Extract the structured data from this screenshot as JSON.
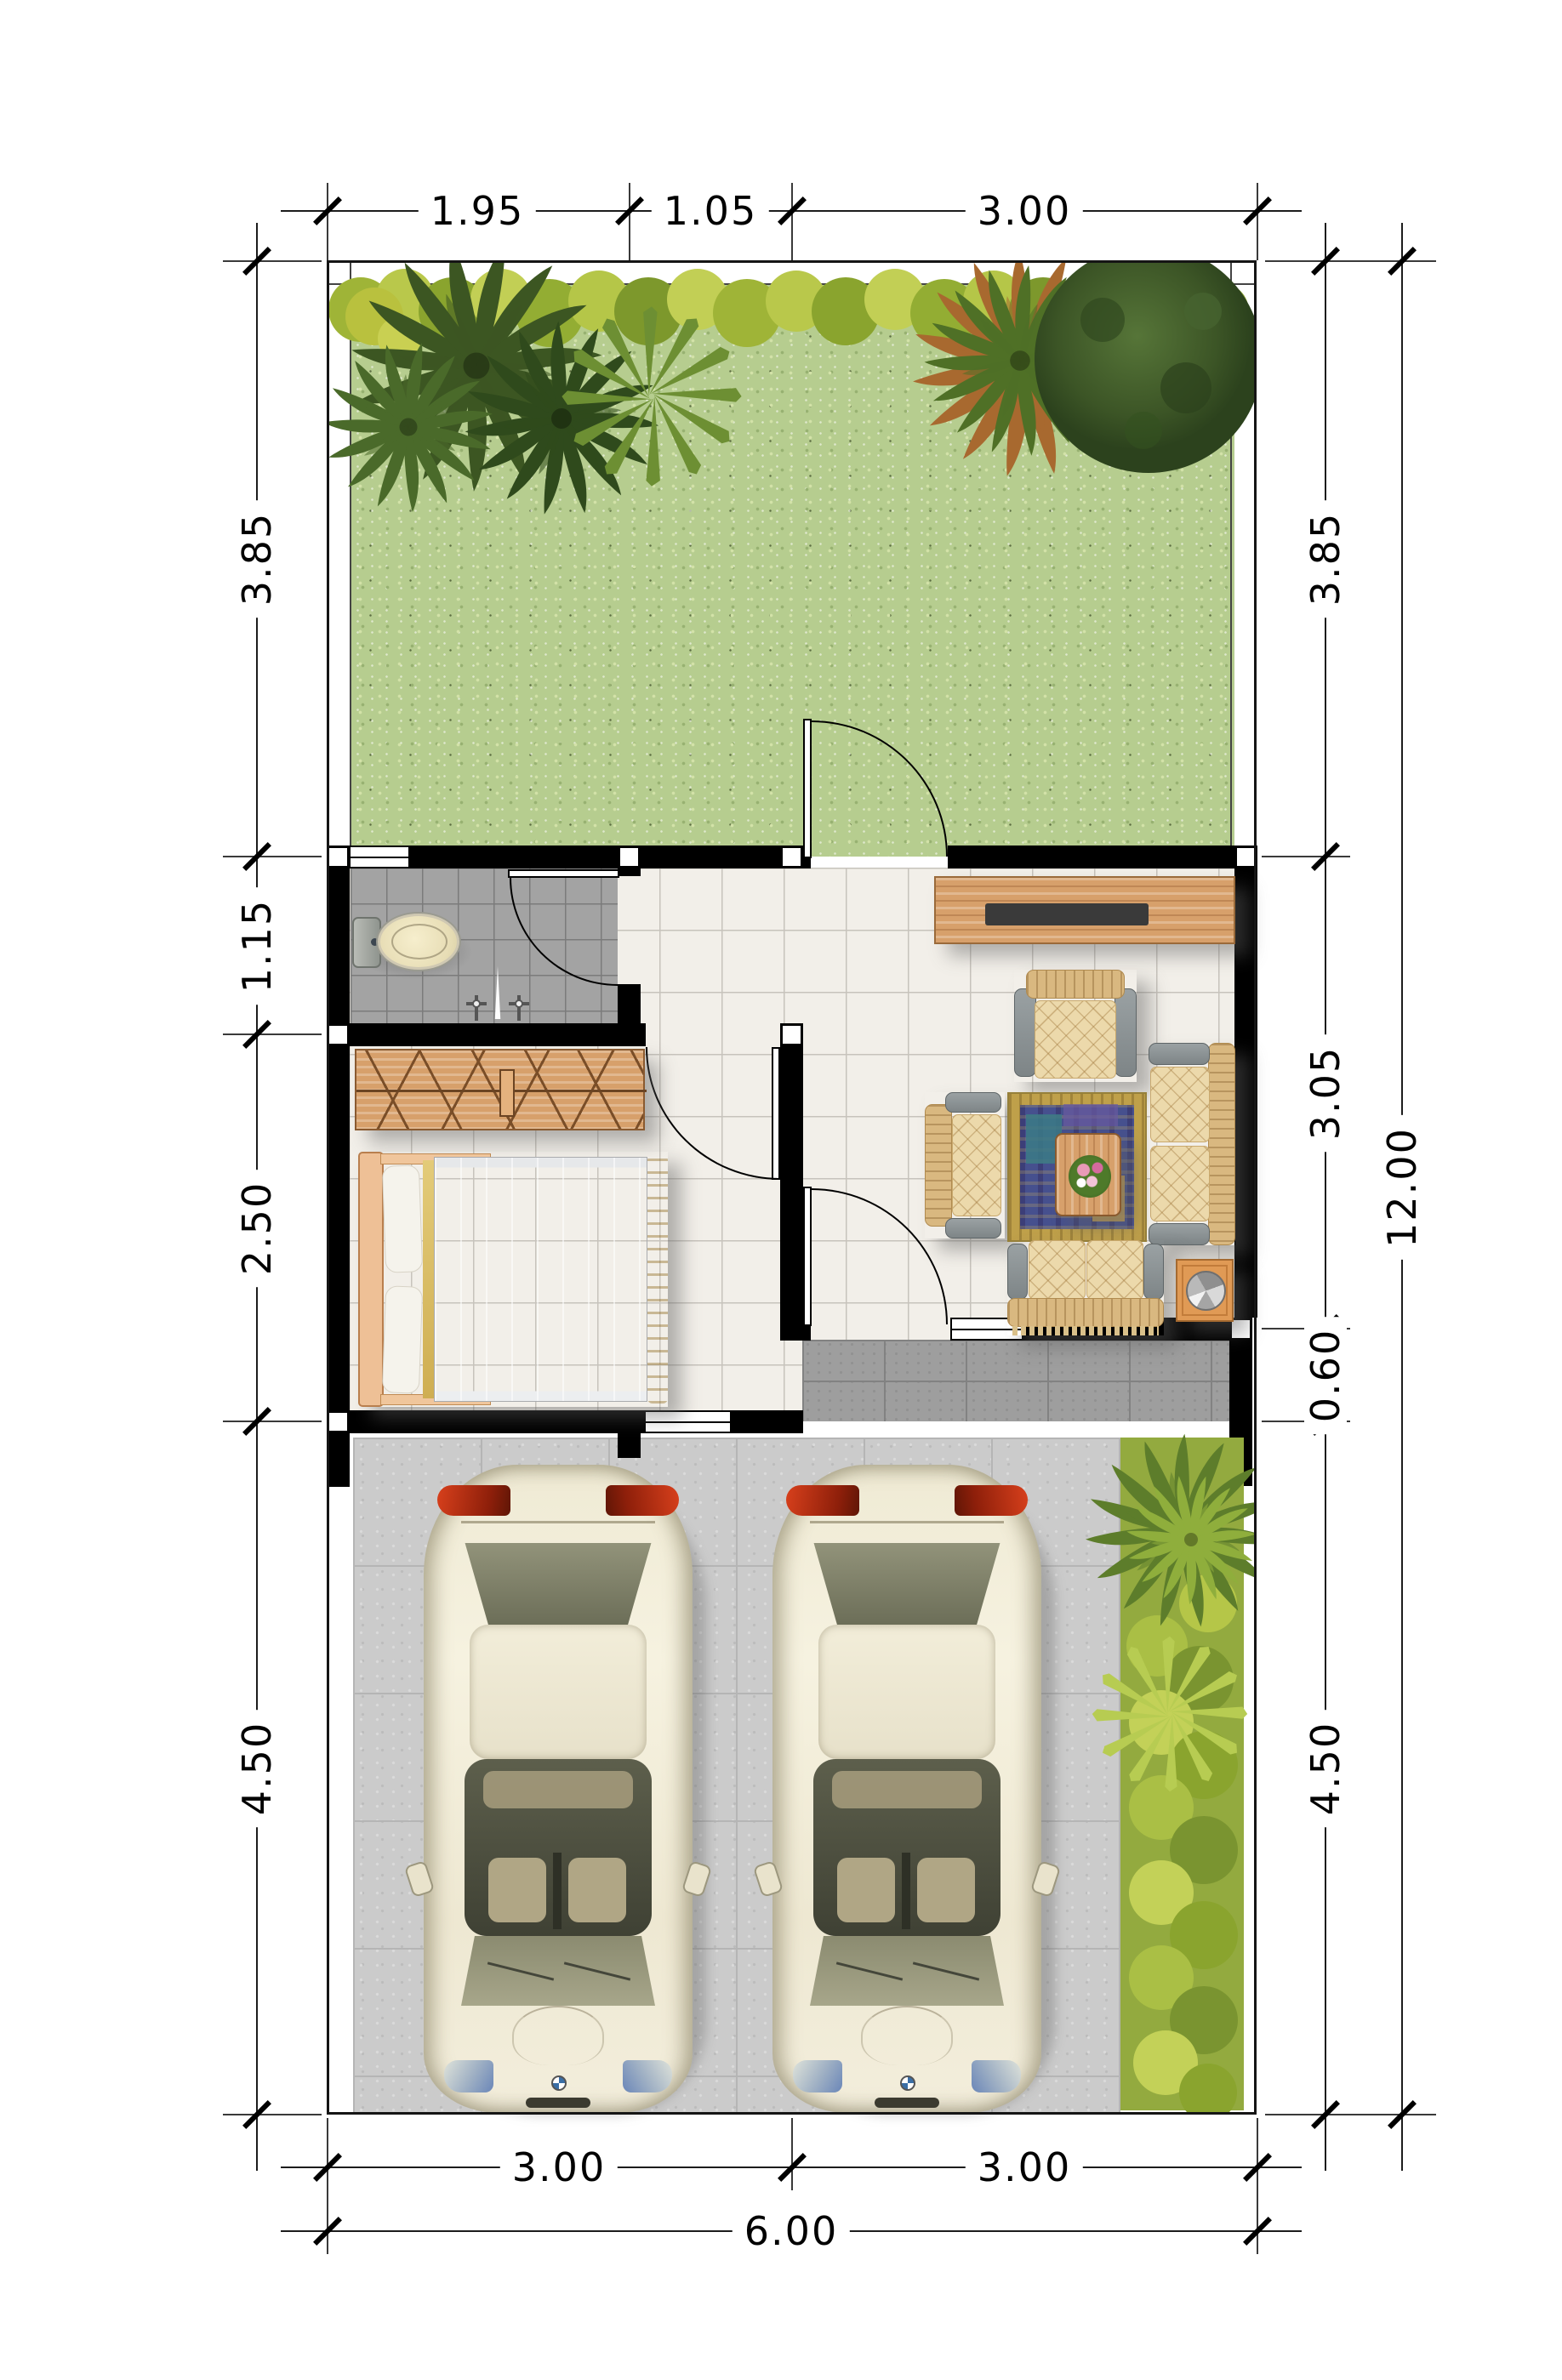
{
  "plan": {
    "type": "house-site-floor-plan-top-view",
    "dimensions": {
      "top": [
        "1.95",
        "1.05",
        "3.00"
      ],
      "left": [
        "3.85",
        "1.15",
        "2.50",
        "4.50"
      ],
      "right": [
        "3.85",
        "3.05",
        "0.60",
        "4.50"
      ],
      "right_total": "12.00",
      "bottom": [
        "3.00",
        "3.00"
      ],
      "bottom_total": "6.00"
    },
    "areas": [
      "garden",
      "bathroom",
      "hall",
      "living-room",
      "bedroom",
      "terrace",
      "carport",
      "planting-strip"
    ],
    "furniture_icons": [
      "toilet",
      "faucet-taps",
      "wardrobe",
      "double-bed",
      "tv-cabinet",
      "armchair",
      "two-seat-sofa",
      "coffee-table",
      "rug",
      "side-table-with-bowl",
      "car",
      "palm-tree",
      "fern",
      "hedge",
      "round-tree"
    ],
    "colors": {
      "wall": "#000000",
      "grass": "#b6cd8f",
      "hedge_light": "#b9c84b",
      "hedge_dark": "#7d982c",
      "interior_tile": "#f2efe9",
      "bathroom_tile": "#a3a3a3",
      "terrace_tile": "#9e9e9e",
      "carport_concrete": "#cbcbcb",
      "wood": "#d7a06b",
      "fabric": "#ecd9ab",
      "rug_field": "#46508e",
      "rug_border": "#bfa04a",
      "gold": "#d9b95e",
      "car_body": "#f3eedc",
      "taillight_red": "#c0300f",
      "dimension_text": "#000000"
    }
  }
}
